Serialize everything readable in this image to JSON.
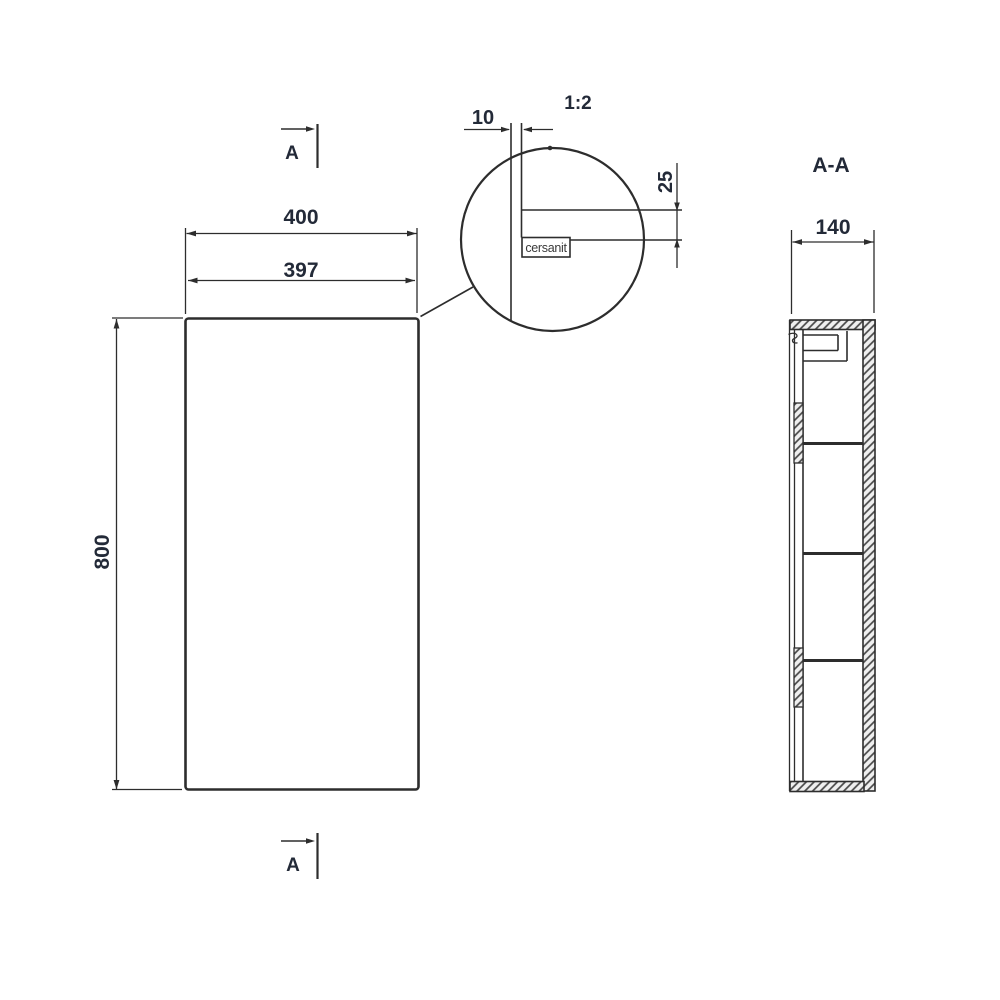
{
  "drawing_type": "furniture-technical-drawing",
  "views": {
    "front": {
      "marker_top": "A",
      "marker_bottom": "A",
      "dim_outer_width": "400",
      "dim_door_width": "397",
      "dim_height": "800"
    },
    "detail": {
      "scale": "1:2",
      "dim_gap": "10",
      "dim_offset": "25",
      "logo": "cersanit"
    },
    "section": {
      "label": "A-A",
      "dim_depth": "140"
    }
  },
  "colors": {
    "background": "#ffffff",
    "line": "#2d2d2d",
    "text": "#232a38",
    "hatch_fill": "#efefef",
    "hatch_stroke": "#474747"
  }
}
